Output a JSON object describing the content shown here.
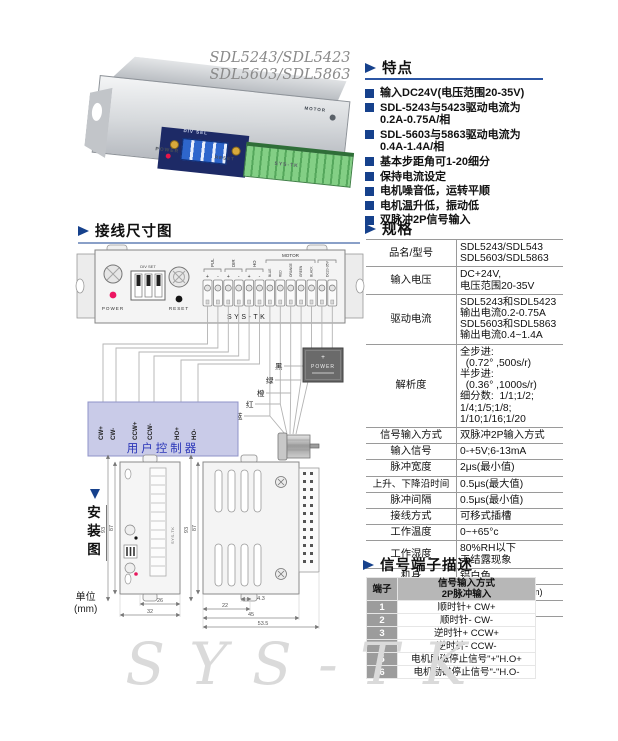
{
  "page": {
    "watermark": "SYS-TK"
  },
  "photo": {
    "model_line1": "SDL5243/SDL5423",
    "model_line2": "SDL5603/SDL5863",
    "labels": {
      "dip": "DIV SEL",
      "power": "POWER",
      "reset": "RESET",
      "brand": "SYS-TK",
      "motor": "MOTOR"
    }
  },
  "features": {
    "heading": "特点",
    "items": [
      "输入DC24V(电压范围20-35V)",
      "SDL-5243与5423驱动电流为\n0.2A-0.75A/相",
      "SDL-5603与5863驱动电流为\n0.4A-1.4A/相",
      "基本步距角可1-20细分",
      "保持电流设定",
      "电机噪音低，运转平顺",
      "电机温升低，振动低",
      "双脉冲2P信号输入"
    ]
  },
  "specs": {
    "heading": "规格",
    "rows": [
      {
        "label": "品名/型号",
        "value": "SDL5243/SDL543\nSDL5603/SDL5863"
      },
      {
        "label": "输入电压",
        "value": "DC+24V,\n电压范围20-35V"
      },
      {
        "label": "驱动电流",
        "value": "SDL5243和SDL5423\n输出电流0.2-0.75A\nSDL5603和SDL5863\n输出电流0.4~1.4A"
      },
      {
        "label": "解析度",
        "value": "全步进:\n  (0.72° ,500s/r)\n半步进:\n  (0.36° ,1000s/r)\n细分数:  1/1;1/2;\n1/4;1/5;1/8;\n1/10;1/16;1/20"
      },
      {
        "label": "信号输入方式",
        "value": "双脉冲2P输入方式"
      },
      {
        "label": "输入信号",
        "value": "0-+5V;6-13mA"
      },
      {
        "label": "脉冲宽度",
        "value": "2μs(最小值)"
      },
      {
        "label": "上升、下降沿时间",
        "value": "0.5μs(最大值)"
      },
      {
        "label": "脉冲间隔",
        "value": "0.5μs(最小值)"
      },
      {
        "label": "接线方式",
        "value": "可移式插槽"
      },
      {
        "label": "工作温度",
        "value": "0~+65°c"
      },
      {
        "label": "工作湿度",
        "value": "80%RH以下\n无结露现象"
      },
      {
        "label": "机身",
        "value": "铝白色"
      },
      {
        "label": "尺寸",
        "value": "L93 xW45xH32(mm)"
      },
      {
        "label": "重量",
        "value": "120g"
      }
    ]
  },
  "signals": {
    "heading": "信号端子描述",
    "col_pin": "端子",
    "header_line1": "信号输入方式",
    "header_line2": "2P脉冲输入",
    "rows": [
      {
        "pin": "1",
        "desc": "顺时针+ CW+"
      },
      {
        "pin": "2",
        "desc": "顺时针- CW-"
      },
      {
        "pin": "3",
        "desc": "逆时针+ CCW+"
      },
      {
        "pin": "4",
        "desc": "逆时针- CCW-"
      },
      {
        "pin": "5",
        "desc": "电机励磁停止信号\"+\"H.O+"
      },
      {
        "pin": "6",
        "desc": "电机励磁停止信号\"-\"H.O-"
      }
    ]
  },
  "wiring": {
    "heading": "接线尺寸图",
    "plate": {
      "power_label": "POWER",
      "reset_label": "RESET",
      "dip_label": "DIV SET",
      "brand": "SYS-TK",
      "pul": "PUL",
      "dir": "DIR",
      "ho": "HO",
      "motor_group": "MOTOR",
      "dc_group": "DC20-35V",
      "polarity": [
        "+",
        "-",
        "+",
        "-",
        "+",
        "-"
      ],
      "motor_colors": [
        "BLUE",
        "RED",
        "ORANGE",
        "GREEN",
        "BLACK"
      ]
    },
    "controller": {
      "title": "用户控制器",
      "pins": [
        "CW+",
        "CW-",
        "CCW+",
        "CCW-",
        "HO+",
        "HO-"
      ]
    },
    "wire_labels": [
      "蓝",
      "红",
      "橙",
      "绿",
      "黑"
    ],
    "supply": {
      "plus": "+",
      "label": "POWER"
    }
  },
  "install": {
    "heading": "安装图",
    "unit": "单位\n(mm)",
    "front": {
      "height_outer": "93",
      "height_inner": "87",
      "width_inner": "26",
      "width_outer": "32",
      "brand": "SYS-TK"
    },
    "side": {
      "height_outer": "93",
      "height_inner": "87",
      "dim_tab": "4.3",
      "dim_hole": "22",
      "dim_body": "45",
      "dim_total": "53.5"
    }
  }
}
